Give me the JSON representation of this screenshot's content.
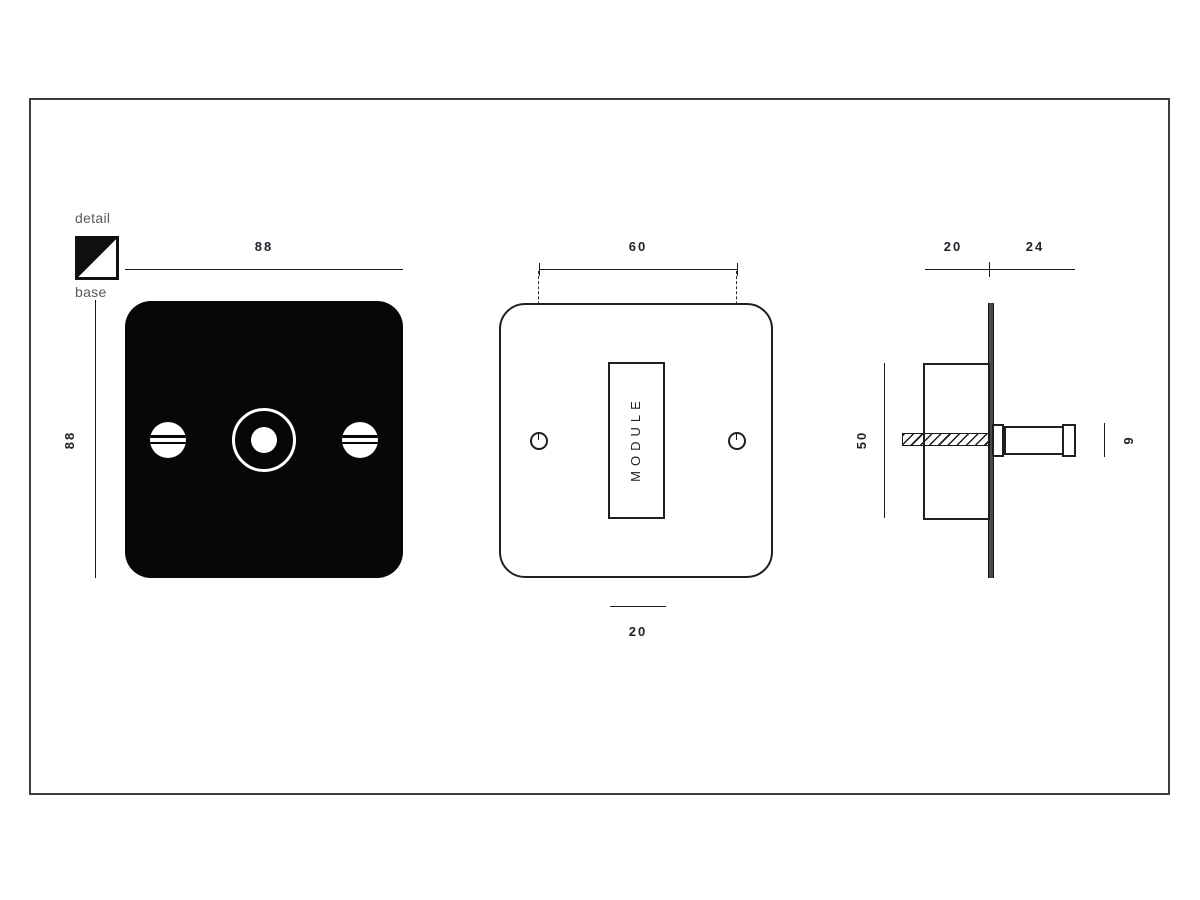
{
  "legend": {
    "detail_label": "detail",
    "base_label": "base"
  },
  "front_view": {
    "width_dim": "88",
    "height_dim": "88"
  },
  "face_view": {
    "hole_spacing_dim": "60",
    "module_label": "MODULE",
    "module_width_dim": "20"
  },
  "side_view": {
    "box_depth_dim": "20",
    "knob_projection_dim": "24",
    "box_height_dim": "50",
    "knob_diameter_dim": "9"
  },
  "colors": {
    "ink": "#1a1a1a",
    "dim_text": "#20242b",
    "muted_text": "#58595b",
    "plate_fill": "#070707",
    "frame_border": "#3d3d3d"
  }
}
